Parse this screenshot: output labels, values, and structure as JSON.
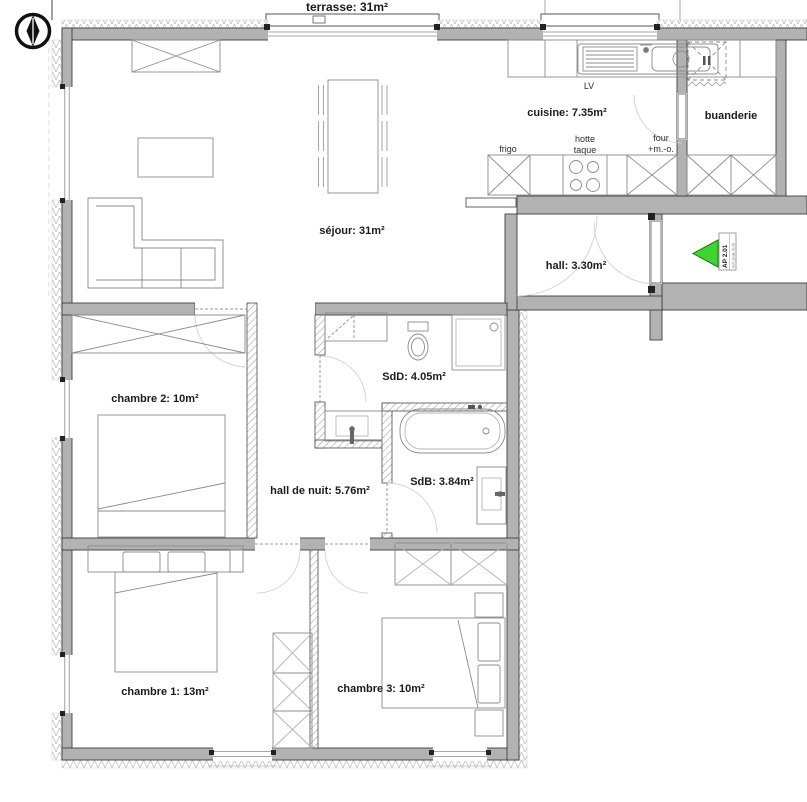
{
  "plan": {
    "labels": {
      "terrasse": "terrasse: 31m²",
      "sejour": "séjour: 31m²",
      "cuisine": "cuisine: 7.35m²",
      "buanderie": "buanderie",
      "hall": "hall: 3.30m²",
      "sdd": "SdD: 4.05m²",
      "sdb": "SdB: 3.84m²",
      "hall_de_nuit": "hall de nuit: 5.76m²",
      "chambre1": "chambre 1: 13m²",
      "chambre2": "chambre 2: 10m²",
      "chambre3": "chambre 3: 10m²"
    },
    "appliances": {
      "lv": "LV",
      "frigo": "frigo",
      "hotte": "hotte",
      "taque": "taque",
      "four": "four",
      "micro_onde": "+m.-o."
    },
    "unit_tag": {
      "code": "AP 2.01",
      "sub": "Surf. privat. 91.39"
    },
    "colors": {
      "wall": "#b2b2b2",
      "entrance_arrow": "#3fd42f"
    }
  }
}
